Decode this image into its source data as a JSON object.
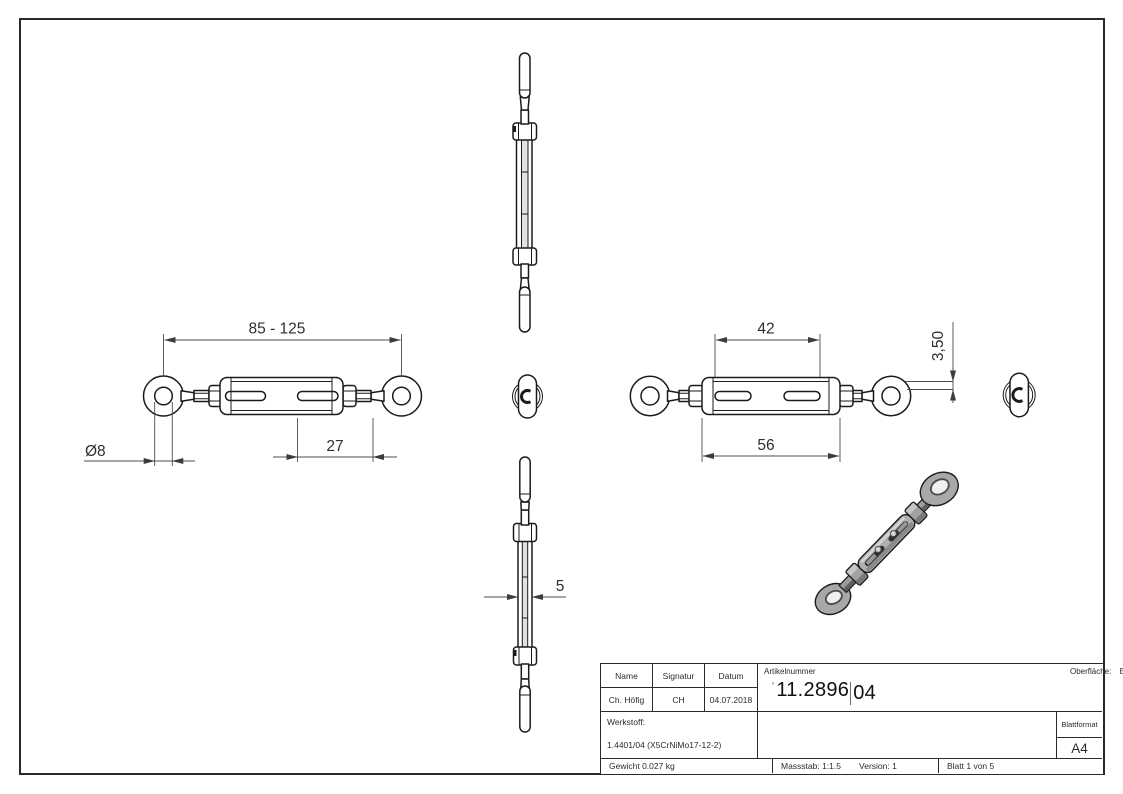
{
  "dimensions": {
    "overall_length": "85 - 125",
    "eye_hole_diameter": "Ø8",
    "slot_dim": "27",
    "slot_span": "42",
    "body_length": "56",
    "eye_thickness": "3,50",
    "side_width": "5"
  },
  "title_block": {
    "name_header": "Name",
    "signatur_header": "Signatur",
    "datum_header": "Datum",
    "name_value": "Ch. Höfig",
    "signatur_value": "CH",
    "datum_value": "04.07.2018",
    "artikelnummer_label": "Artikelnummer",
    "artikelnummer_prefix": "’",
    "artikelnummer_main": "11.2896",
    "artikelnummer_suffix": "04",
    "oberflaeche_label": "Oberfläche:",
    "oberflaeche_value": "Elektropoliert",
    "werkstoff_label": "Werkstoff:",
    "werkstoff_value": "1.4401/04 (X5CrNiMo17-12-2)",
    "blattformat_label": "Blattformat",
    "blattformat_value": "A4",
    "gewicht": "Gewicht 0.027 kg",
    "massstab": "Massstab: 1:1.5",
    "version": "Version: 1",
    "blatt": "Blatt 1 von 5"
  }
}
